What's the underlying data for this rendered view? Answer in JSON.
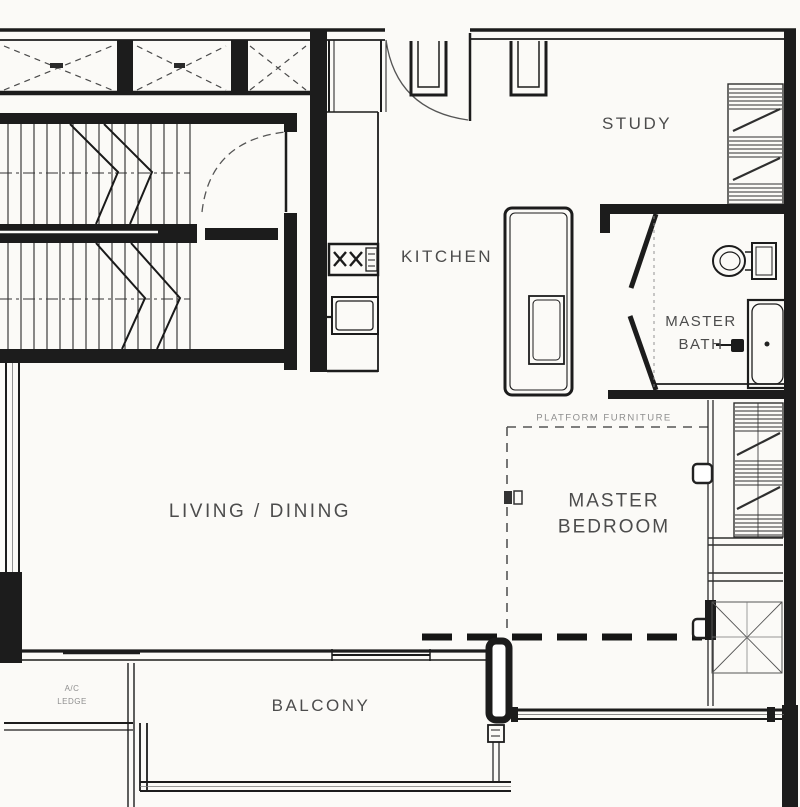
{
  "page": {
    "background": "#fbfaf7",
    "wall_color": "#1c1c1c",
    "line_color": "#3a3a3a",
    "label_color": "#4c4c4c",
    "faint_label_color": "#8f8f8f"
  },
  "floor_plan": {
    "rooms": {
      "study": {
        "label": "STUDY"
      },
      "kitchen": {
        "label": "KITCHEN"
      },
      "master_bath": {
        "line1": "MASTER",
        "line2": "BATH"
      },
      "living_dining": {
        "label": "LIVING / DINING"
      },
      "master_bedroom": {
        "line1": "MASTER",
        "line2": "BEDROOM"
      },
      "balcony": {
        "label": "BALCONY"
      },
      "ac_ledge": {
        "line1": "A/C",
        "line2": "LEDGE"
      }
    },
    "annotations": {
      "platform_furniture": "PLATFORM FURNITURE"
    }
  }
}
